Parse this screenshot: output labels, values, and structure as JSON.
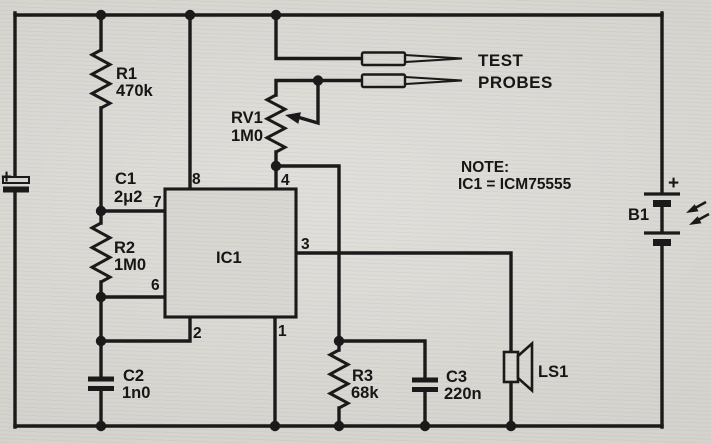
{
  "diagram": {
    "kind": "analog circuit schematic (555 continuity tester)",
    "colors": {
      "ink": "#1a1a1a",
      "paper": "#d7d5d0"
    },
    "probes": {
      "line1": "TEST",
      "line2": "PROBES"
    },
    "note": {
      "line1": "NOTE:",
      "line2": "IC1 = ICM75555"
    },
    "components": {
      "r1": {
        "ref": "R1",
        "value": "470k"
      },
      "r2": {
        "ref": "R2",
        "value": "1M0"
      },
      "r3": {
        "ref": "R3",
        "value": "68k"
      },
      "rv1": {
        "ref": "RV1",
        "value": "1M0"
      },
      "c1": {
        "ref": "C1",
        "value": "2μ2",
        "plus": "+"
      },
      "c2": {
        "ref": "C2",
        "value": "1n0"
      },
      "c3": {
        "ref": "C3",
        "value": "220n"
      },
      "b1": {
        "ref": "B1",
        "plus": "+"
      },
      "ls1": {
        "ref": "LS1"
      },
      "ic1": {
        "ref": "IC1",
        "pin1": "1",
        "pin2": "2",
        "pin3": "3",
        "pin4": "4",
        "pin6": "6",
        "pin7": "7",
        "pin8": "8"
      }
    }
  }
}
